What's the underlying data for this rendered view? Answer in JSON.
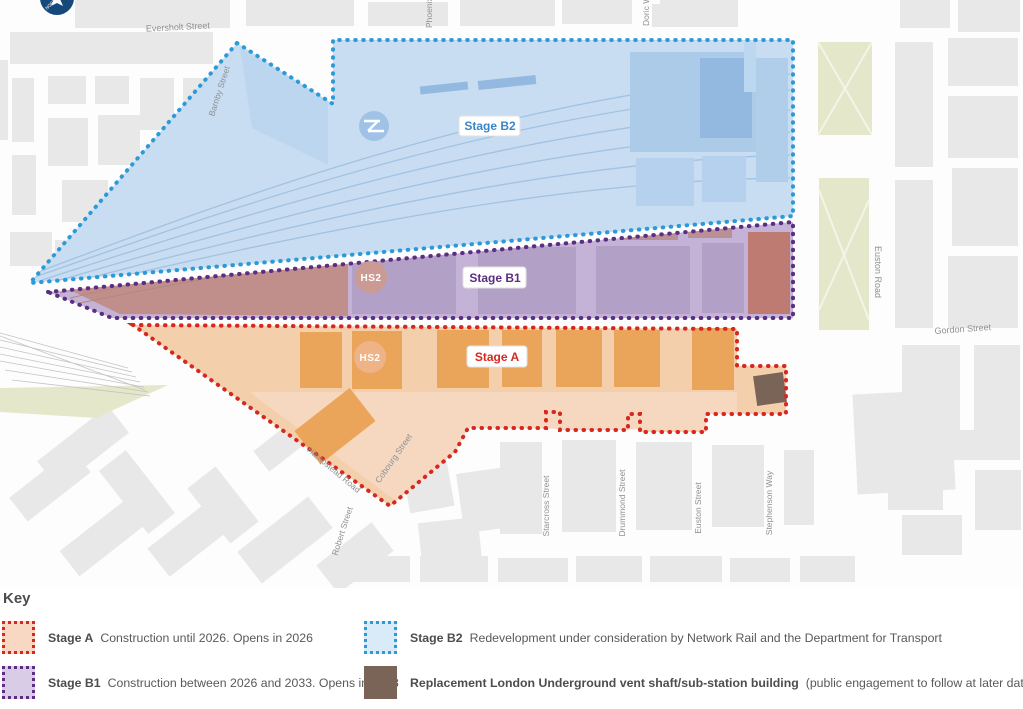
{
  "map": {
    "stages": {
      "b2": {
        "label": "Stage B2",
        "color": "#3a87c8",
        "fill": "#c8ddf1",
        "border": "#2d9ad8"
      },
      "b1": {
        "label": "Stage B1",
        "color": "#5b2d83",
        "fill": "#c4b3d6",
        "border": "#5b2d83"
      },
      "a": {
        "label": "Stage A",
        "color": "#d6281e",
        "fill": "#f4cfac",
        "border": "#d6281e"
      }
    },
    "logos": {
      "hs2": "HS2",
      "north": "NORTH"
    },
    "vent_building_color": "#7a6457",
    "streets": {
      "eversholt": "Eversholt Street",
      "barnby": "Barnby Street",
      "phoenix": "Phoenix Road",
      "doric": "Doric Way",
      "euston_road": "Euston Road",
      "gordon": "Gordon Street",
      "hampstead": "Hampstead Road",
      "cobourg": "Cobourg Street",
      "robert": "Robert Street",
      "starcross": "Starcross Street",
      "drummond": "Drummond Street",
      "euston_street": "Euston Street",
      "stephenson": "Stephenson Way"
    }
  },
  "key": {
    "title": "Key",
    "entries": [
      {
        "id": "stage-a",
        "term": "Stage A",
        "desc": "Construction until 2026. Opens in 2026"
      },
      {
        "id": "stage-b1",
        "term": "Stage B1",
        "desc": "Construction between 2026 and 2033. Opens in 2033"
      },
      {
        "id": "stage-b2",
        "term": "Stage B2",
        "desc": "Redevelopment under consideration by Network Rail and the Department for Transport"
      },
      {
        "id": "vent",
        "term": "Replacement London Underground vent shaft/sub-station building",
        "desc": "(public engagement to follow at later date)"
      }
    ]
  }
}
